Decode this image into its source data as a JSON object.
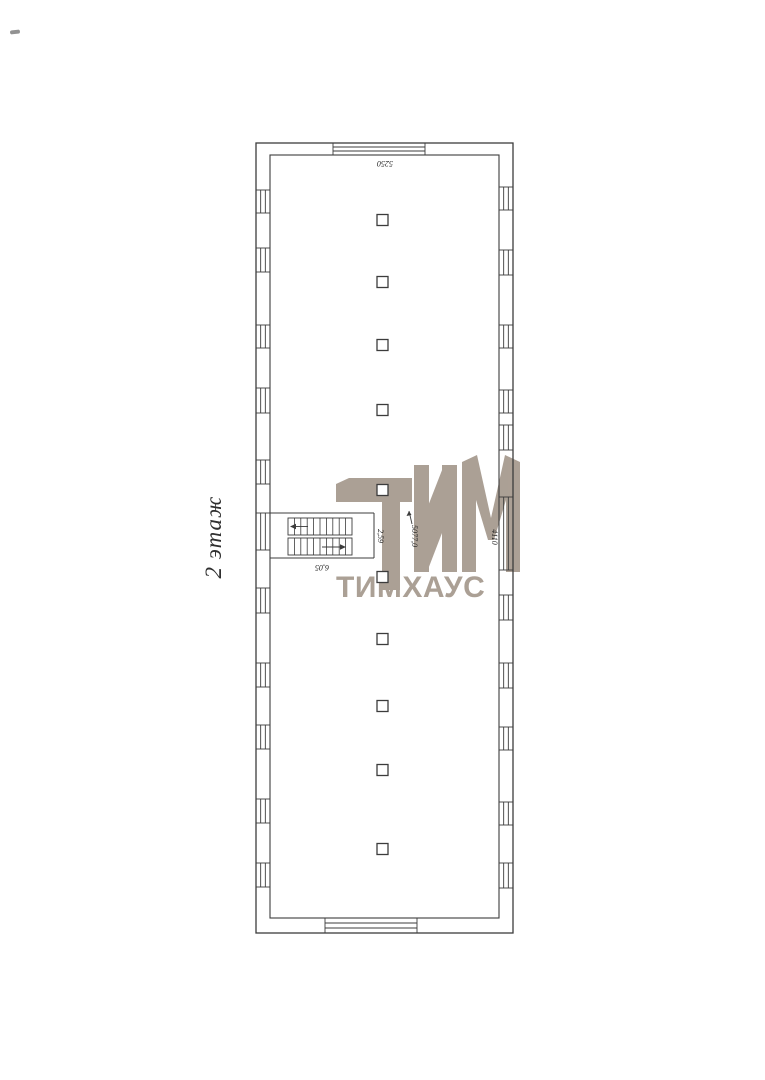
{
  "floor_label": "2 этаж",
  "watermark": {
    "logo_letters": "ТИМ",
    "brand_text": "ТИМХАУС",
    "color": "#a3968a"
  },
  "plan": {
    "line_color": "#3c3c3c",
    "dimensions": [
      {
        "id": "dim-top-wall",
        "text": "5250"
      },
      {
        "id": "dim-stairs-width",
        "text": "6,05"
      },
      {
        "id": "dim-stair-opening",
        "text": "2,59"
      },
      {
        "id": "dim-corridor",
        "text": "5077,0"
      },
      {
        "id": "dim-right-wall",
        "text": "4110"
      }
    ],
    "stairs": {
      "runs": 2,
      "up_arrow_direction": "left",
      "down_arrow_direction": "right"
    },
    "columns_count": 10,
    "windows_count": {
      "left": 11,
      "right": 11,
      "top": 1,
      "bottom": 1
    }
  }
}
